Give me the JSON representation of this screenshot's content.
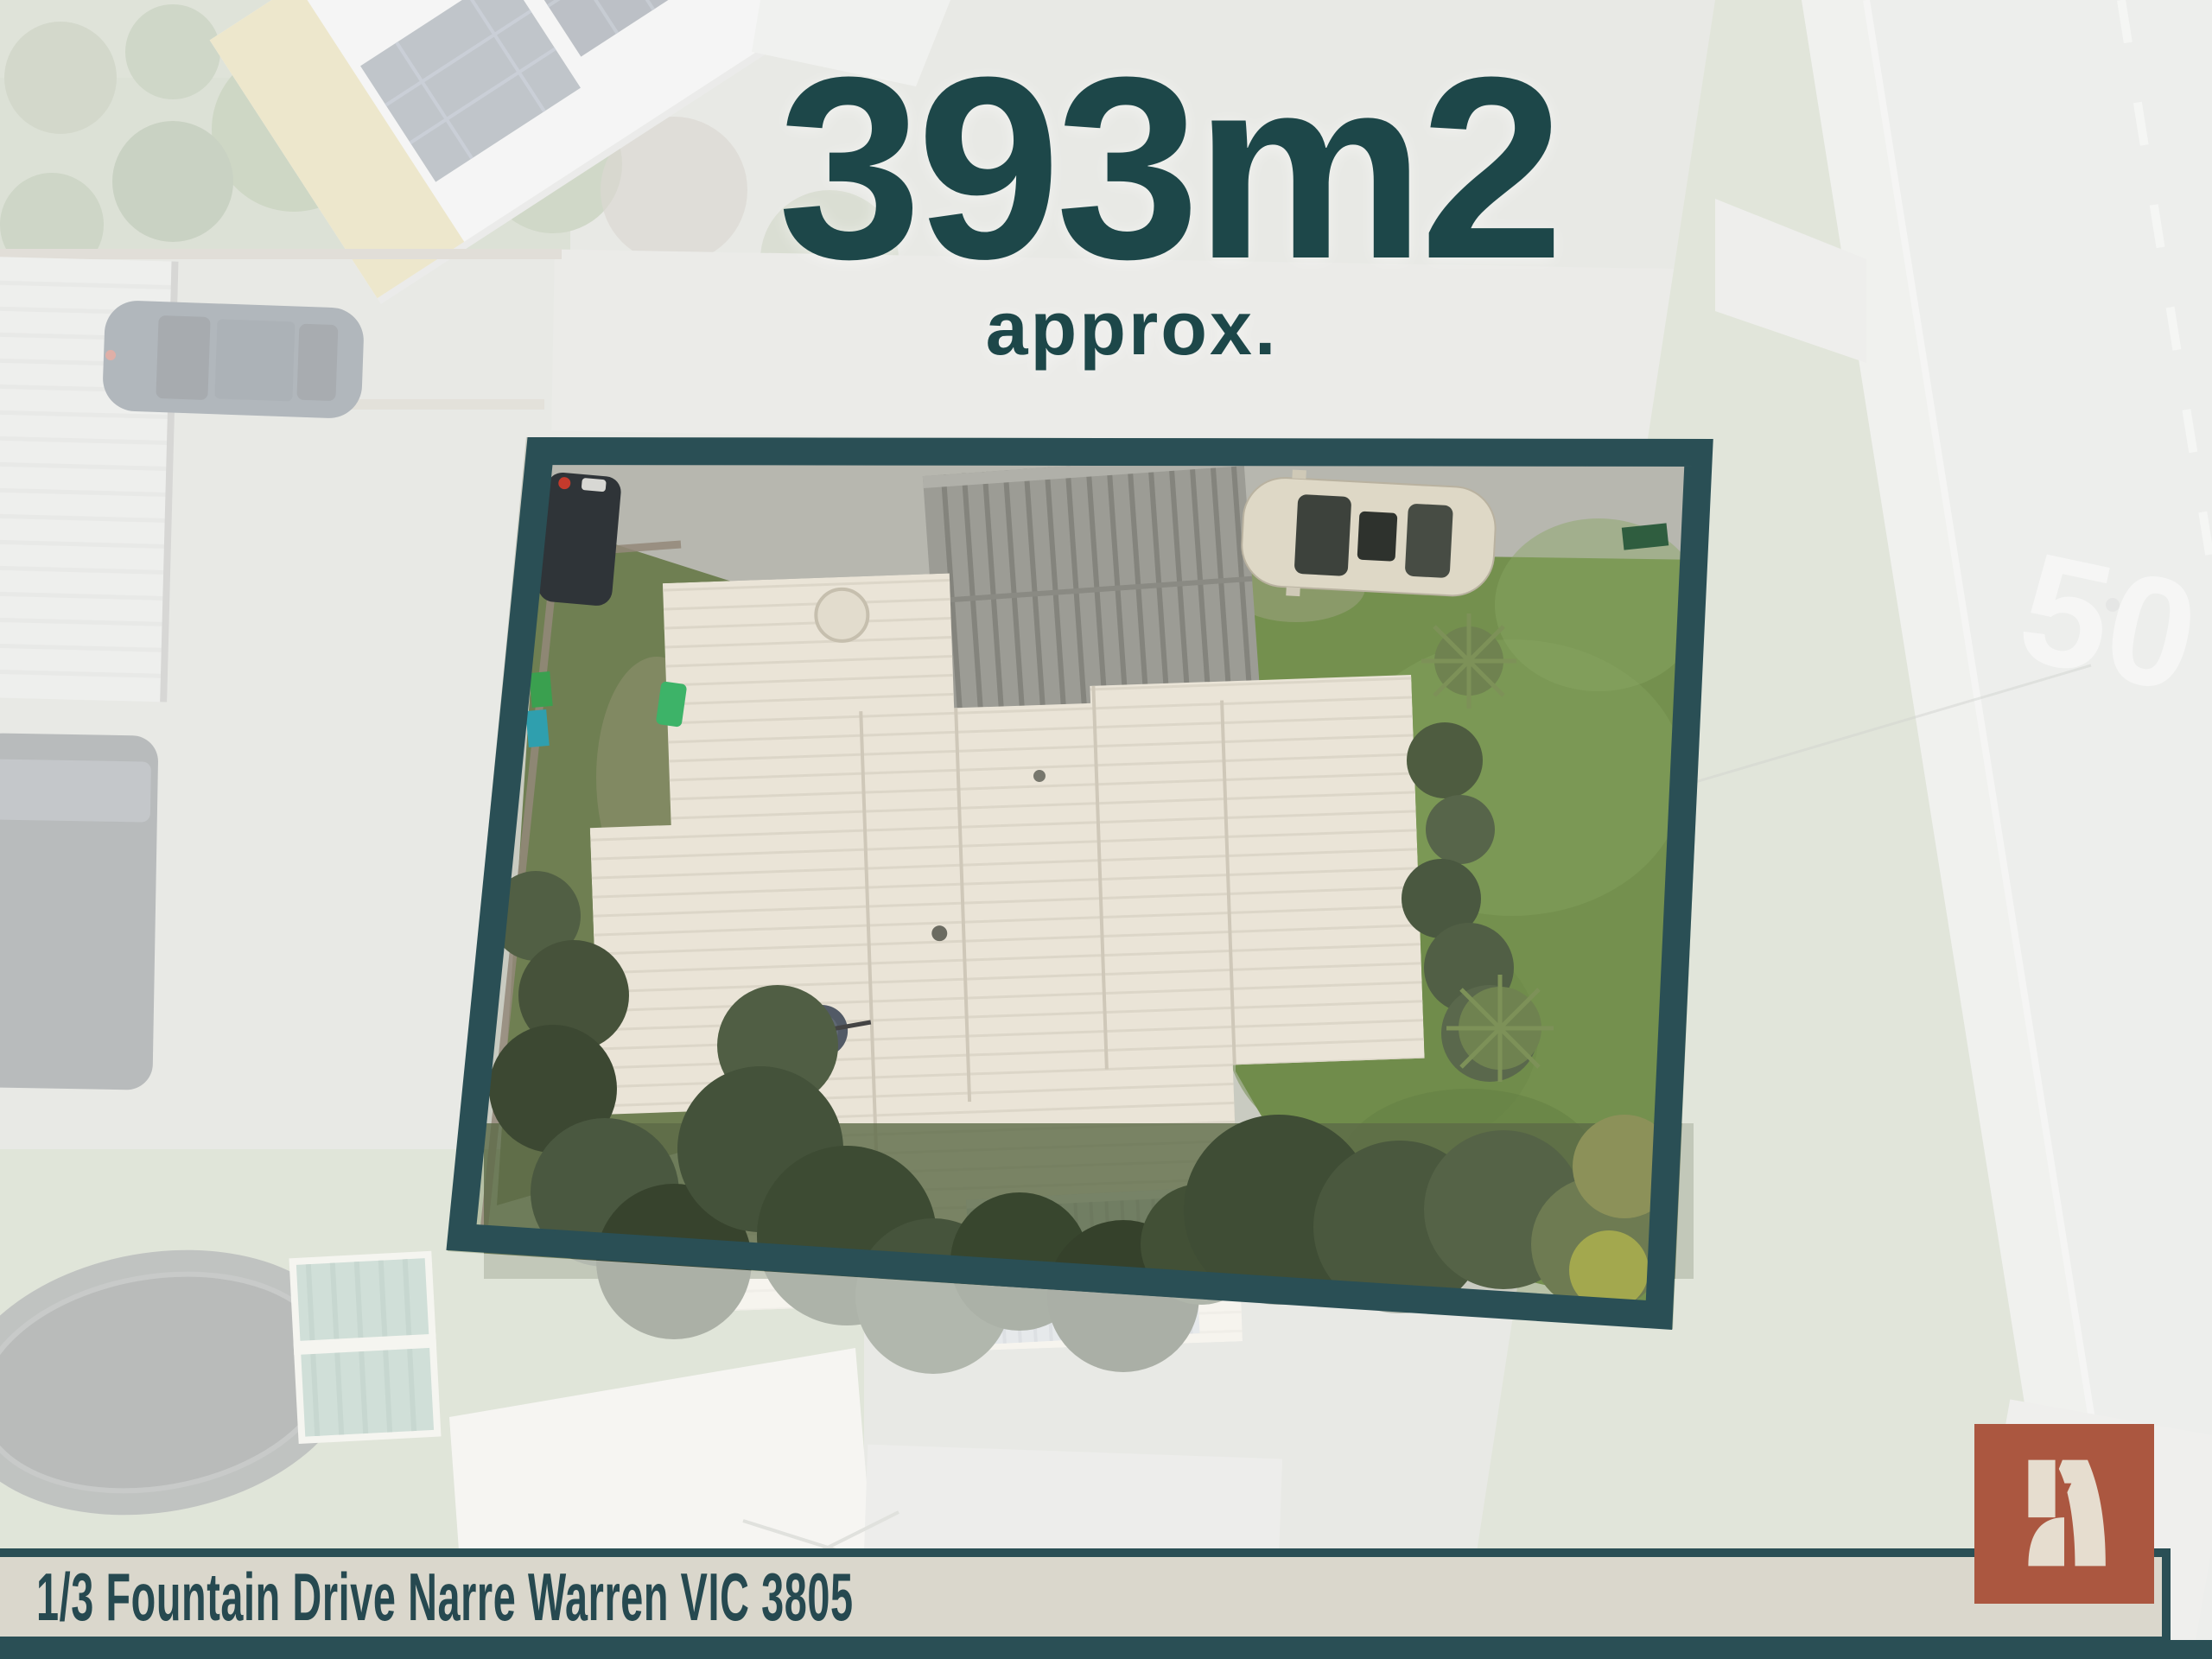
{
  "headline": {
    "area": "393m2",
    "qualifier": "approx."
  },
  "address_bar": {
    "address": "1/3 Fountain Drive Narre Warren VIC 3805"
  },
  "road": {
    "speed_marking": "50"
  },
  "logo": {
    "glyph": "stylized-letter-A"
  },
  "boundary": {
    "shape": "tilted-quadrilateral",
    "style": "solid-teal-outline, exterior faded white"
  },
  "colors": {
    "boundary_teal": "#2a4f55",
    "headline_teal": "#1d4749",
    "address_text_teal": "#264950",
    "bar_cream": "#dad7cc",
    "logo_rust": "#ab5740",
    "logo_glyph_cream": "#e6ddcf",
    "roof_cream": "#eae4d7",
    "lawn_green": "#74904e"
  }
}
